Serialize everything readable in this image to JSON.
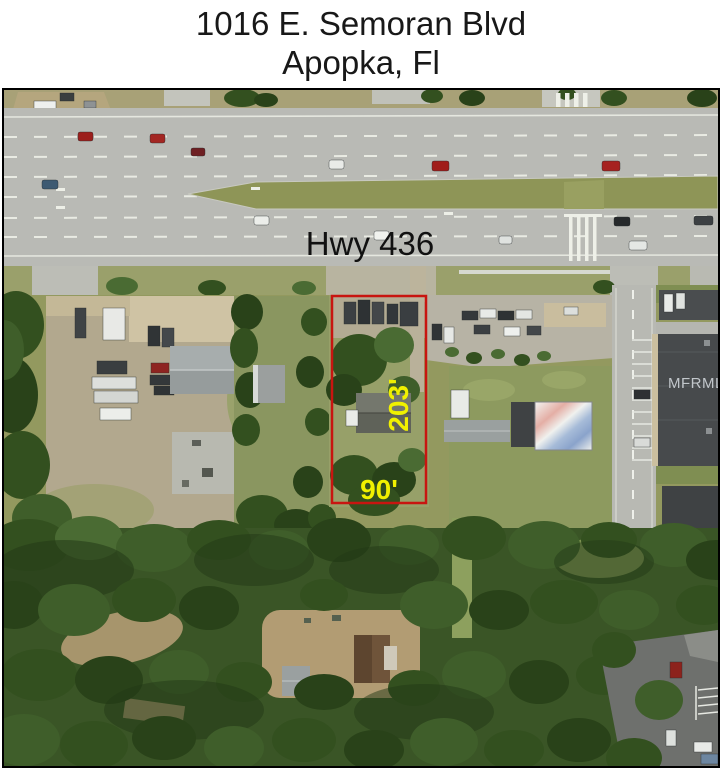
{
  "header": {
    "line1": "1016 E. Semoran Blvd",
    "line2": "Apopka, Fl"
  },
  "map": {
    "road_label": "Hwy 436",
    "parcel": {
      "depth_label": "203'",
      "width_label": "90'"
    },
    "watermark": "MFRMLS"
  },
  "colors": {
    "parcel_boundary": "#c81510",
    "dimension_text": "#f0f000",
    "road_label_text": "#111111",
    "watermark_text": "#d7dce1",
    "photo_border": "#000000"
  }
}
